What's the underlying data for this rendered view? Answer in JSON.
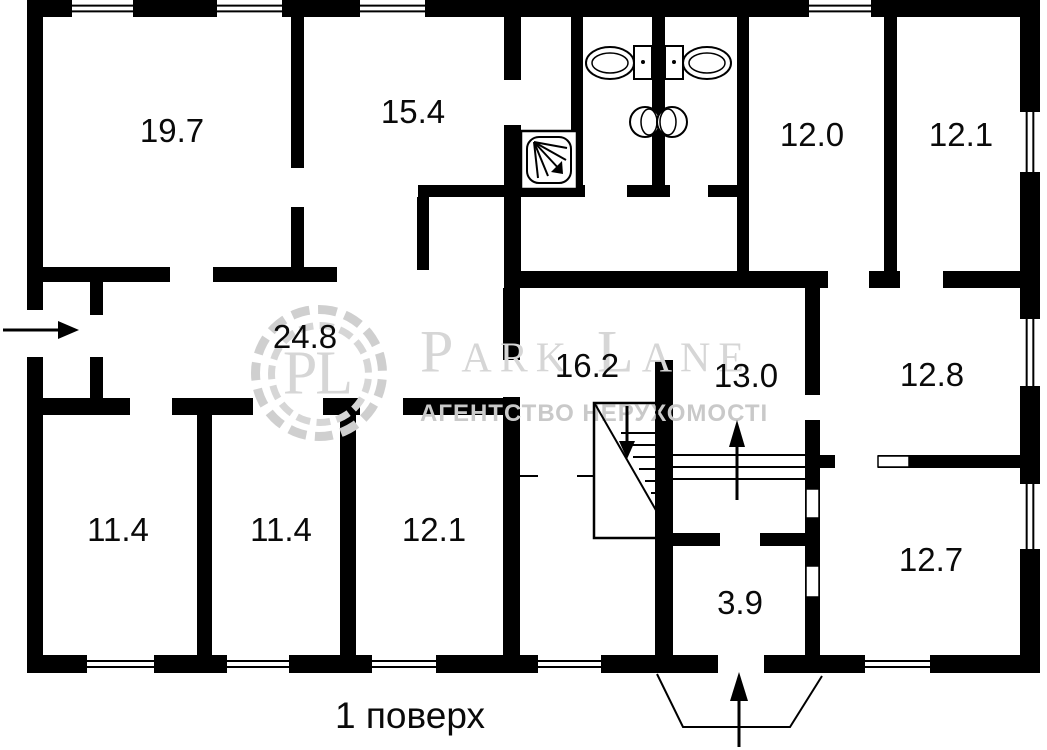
{
  "caption": {
    "text": "1 поверх"
  },
  "watermark": {
    "monogram": "PL",
    "brand": "Park Lane",
    "subtitle": "АГЕНТСТВО НЕРУХОМОСТІ"
  },
  "colors": {
    "wall": "#000000",
    "background": "#ffffff",
    "label": "#0a0a0a",
    "watermark_gray": "#d6d6d6",
    "watermark_subtitle_gray": "#c9c9c9"
  },
  "plan": {
    "rooms": [
      {
        "name": "room-19-7",
        "area": "19.7",
        "label_x": 172,
        "label_y": 131
      },
      {
        "name": "room-15-4",
        "area": "15.4",
        "label_x": 413,
        "label_y": 112
      },
      {
        "name": "room-12-0",
        "area": "12.0",
        "label_x": 812,
        "label_y": 135
      },
      {
        "name": "room-12-1-top",
        "area": "12.1",
        "label_x": 961,
        "label_y": 135
      },
      {
        "name": "corridor-24-8",
        "area": "24.8",
        "label_x": 305,
        "label_y": 337
      },
      {
        "name": "hall-16-2",
        "area": "16.2",
        "label_x": 587,
        "label_y": 366
      },
      {
        "name": "hall-13-0",
        "area": "13.0",
        "label_x": 746,
        "label_y": 376
      },
      {
        "name": "room-12-8",
        "area": "12.8",
        "label_x": 932,
        "label_y": 375
      },
      {
        "name": "room-11-4-left",
        "area": "11.4",
        "label_x": 118,
        "label_y": 530
      },
      {
        "name": "room-11-4-right",
        "area": "11.4",
        "label_x": 281,
        "label_y": 530
      },
      {
        "name": "room-12-1-bottom",
        "area": "12.1",
        "label_x": 434,
        "label_y": 530
      },
      {
        "name": "room-12-7",
        "area": "12.7",
        "label_x": 931,
        "label_y": 560
      },
      {
        "name": "entry-3-9",
        "area": "3.9",
        "label_x": 740,
        "label_y": 603
      }
    ],
    "walls": [
      [
        27,
        0,
        1013,
        17
      ],
      [
        27,
        0,
        16,
        673
      ],
      [
        1020,
        0,
        20,
        673
      ],
      [
        27,
        655,
        1013,
        18
      ],
      [
        291,
        17,
        13,
        250
      ],
      [
        43,
        267,
        294,
        15
      ],
      [
        90,
        282,
        13,
        33
      ],
      [
        90,
        357,
        13,
        41
      ],
      [
        504,
        17,
        17,
        261
      ],
      [
        571,
        17,
        12,
        170
      ],
      [
        652,
        17,
        13,
        173
      ],
      [
        737,
        17,
        12,
        261
      ],
      [
        418,
        185,
        320,
        12
      ],
      [
        417,
        197,
        12,
        73
      ],
      [
        884,
        17,
        13,
        255
      ],
      [
        504,
        271,
        516,
        17
      ],
      [
        503,
        288,
        17,
        367
      ],
      [
        43,
        398,
        477,
        17
      ],
      [
        197,
        415,
        15,
        240
      ],
      [
        340,
        415,
        16,
        240
      ],
      [
        655,
        360,
        18,
        295
      ],
      [
        805,
        288,
        15,
        367
      ],
      [
        673,
        533,
        134,
        13
      ],
      [
        820,
        455,
        200,
        13
      ]
    ],
    "door_openings": [
      [
        27,
        310,
        16,
        47
      ],
      [
        291,
        168,
        13,
        39
      ],
      [
        170,
        267,
        43,
        15
      ],
      [
        504,
        80,
        17,
        45
      ],
      [
        585,
        185,
        42,
        12
      ],
      [
        670,
        185,
        38,
        12
      ],
      [
        828,
        271,
        41,
        17
      ],
      [
        900,
        271,
        43,
        17
      ],
      [
        503,
        360,
        17,
        37
      ],
      [
        130,
        398,
        42,
        17
      ],
      [
        253,
        398,
        70,
        17
      ],
      [
        360,
        398,
        43,
        17
      ],
      [
        805,
        395,
        15,
        25
      ],
      [
        835,
        455,
        43,
        13
      ],
      [
        720,
        533,
        40,
        13
      ],
      [
        718,
        655,
        46,
        18
      ]
    ],
    "windows": [
      [
        72,
        0,
        61,
        17,
        "h"
      ],
      [
        217,
        0,
        65,
        17,
        "h"
      ],
      [
        360,
        0,
        65,
        17,
        "h"
      ],
      [
        809,
        0,
        62,
        17,
        "h"
      ],
      [
        87,
        655,
        67,
        18,
        "h"
      ],
      [
        227,
        655,
        62,
        18,
        "h"
      ],
      [
        372,
        655,
        64,
        18,
        "h"
      ],
      [
        538,
        655,
        63,
        18,
        "h"
      ],
      [
        865,
        655,
        65,
        18,
        "h"
      ],
      [
        1020,
        112,
        20,
        60,
        "v"
      ],
      [
        1020,
        319,
        20,
        67,
        "v"
      ],
      [
        1020,
        484,
        20,
        65,
        "v"
      ]
    ],
    "door_leaves": [
      [
        878,
        456,
        31,
        11
      ],
      [
        806,
        489,
        13,
        29
      ],
      [
        806,
        566,
        13,
        31
      ]
    ],
    "stairs": {
      "box": [
        594,
        403,
        63,
        135
      ],
      "diagonal": [
        595,
        404,
        657,
        512
      ],
      "treads": [
        [
          621,
          433,
          656,
          433
        ],
        [
          627,
          445,
          656,
          445
        ],
        [
          633,
          457,
          656,
          457
        ],
        [
          639,
          469,
          656,
          469
        ],
        [
          645,
          481,
          656,
          481
        ],
        [
          651,
          493,
          656,
          493
        ]
      ],
      "right_treads": [
        [
          673,
          455,
          805,
          455
        ],
        [
          673,
          467,
          805,
          467
        ],
        [
          673,
          479,
          805,
          479
        ]
      ]
    },
    "partition_ticks": [
      [
        520,
        476,
        538,
        476
      ],
      [
        577,
        476,
        594,
        476
      ]
    ],
    "porch": [
      [
        657,
        674
      ],
      [
        683,
        727
      ],
      [
        790,
        727
      ],
      [
        822,
        676
      ]
    ],
    "arrows": [
      {
        "name": "entrance-arrow-left",
        "shaft": [
          3,
          330,
          58,
          330
        ],
        "head": [
          [
            58,
            321
          ],
          [
            58,
            339
          ],
          [
            79,
            330
          ]
        ]
      },
      {
        "name": "entrance-arrow-bottom",
        "shaft": [
          739,
          747,
          739,
          700
        ],
        "head": [
          [
            730,
            701
          ],
          [
            748,
            701
          ],
          [
            739,
            672
          ]
        ]
      },
      {
        "name": "stairs-down-arrow",
        "shaft": [
          627,
          406,
          627,
          441
        ],
        "head": [
          [
            619,
            441
          ],
          [
            635,
            441
          ],
          [
            627,
            459
          ]
        ]
      },
      {
        "name": "stairs-up-arrow",
        "shaft": [
          737,
          500,
          737,
          446
        ],
        "head": [
          [
            729,
            447
          ],
          [
            745,
            447
          ],
          [
            737,
            420
          ]
        ]
      }
    ],
    "fixtures": {
      "shower": {
        "outer": [
          521,
          131,
          56,
          58
        ],
        "inner": [
          527,
          137,
          44,
          46
        ],
        "ray_origin": [
          534,
          142
        ],
        "ray_ends": [
          [
            561,
            171
          ],
          [
            548,
            176
          ],
          [
            538,
            178
          ],
          [
            566,
            160
          ],
          [
            567,
            148
          ]
        ],
        "arrow_head": [
          [
            563,
            174
          ],
          [
            551,
            172
          ],
          [
            562,
            161
          ]
        ]
      },
      "toilets": [
        {
          "tank": [
            634,
            46,
            18,
            33
          ],
          "dot": [
            643,
            62
          ],
          "bowl": [
            610,
            63,
            24,
            16
          ],
          "bowl_inner": [
            610,
            63,
            18,
            10
          ]
        },
        {
          "tank": [
            665,
            46,
            18,
            33
          ],
          "dot": [
            674,
            62
          ],
          "bowl": [
            707,
            63,
            24,
            16
          ],
          "bowl_inner": [
            707,
            63,
            18,
            10
          ]
        }
      ],
      "sinks": [
        {
          "outer": [
            645,
            122,
            15
          ],
          "inner": [
            649,
            122,
            8,
            13
          ]
        },
        {
          "outer": [
            672,
            122,
            15
          ],
          "inner": [
            668,
            122,
            8,
            13
          ]
        }
      ]
    }
  }
}
